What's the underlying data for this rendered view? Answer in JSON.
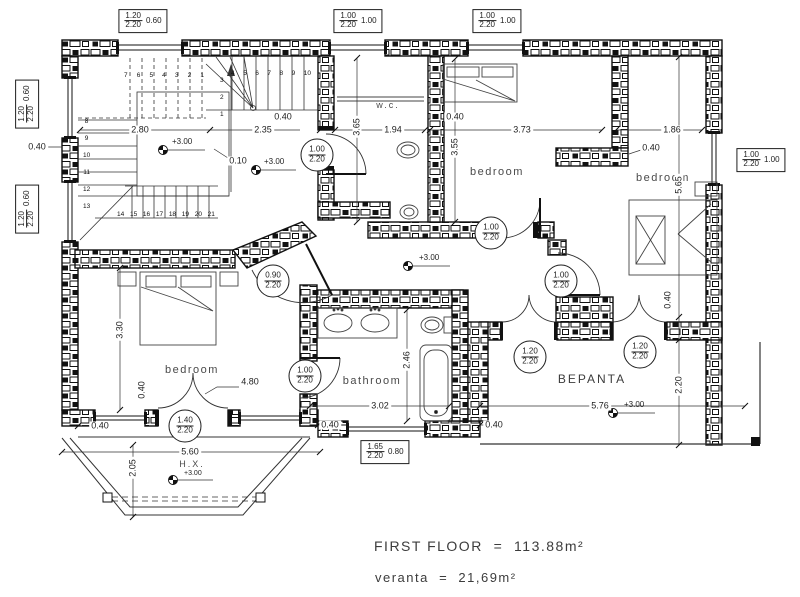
{
  "plan": {
    "rooms": [
      {
        "label": "w.c."
      },
      {
        "label": "bedroom"
      },
      {
        "label": "bedroom"
      },
      {
        "label": "bedroom"
      },
      {
        "label": "bathroom"
      },
      {
        "label": "ΒΕΡΑΝΤΑ"
      },
      {
        "label": "H.X."
      }
    ],
    "window_tags": [
      {
        "w": "1.20",
        "h": "2.20",
        "sill": "0.60"
      },
      {
        "w": "1.00",
        "h": "2.20",
        "sill": "1.00"
      },
      {
        "w": "1.00",
        "h": "2.20",
        "sill": "1.00"
      },
      {
        "w": "1.20",
        "h": "2.20",
        "sill": "0.60"
      },
      {
        "w": "1.20",
        "h": "2.20",
        "sill": "0.60"
      },
      {
        "w": "1.00",
        "h": "2.20",
        "sill": "1.00"
      },
      {
        "w": "1.65",
        "h": "2.20",
        "sill": "0.80"
      }
    ],
    "door_tags": [
      {
        "w": "1.00",
        "h": "2.20"
      },
      {
        "w": "1.00",
        "h": "2.20"
      },
      {
        "w": "1.00",
        "h": "2.20"
      },
      {
        "w": "0.90",
        "h": "2.20"
      },
      {
        "w": "1.00",
        "h": "2.20"
      },
      {
        "w": "1.20",
        "h": "2.20"
      },
      {
        "w": "1.20",
        "h": "2.20"
      },
      {
        "w": "1.40",
        "h": "2.20"
      }
    ],
    "dimensions": [
      {
        "value": "2.80"
      },
      {
        "value": "2.35"
      },
      {
        "value": "1.94"
      },
      {
        "value": "3.73"
      },
      {
        "value": "1.86"
      },
      {
        "value": "0.40"
      },
      {
        "value": "0.40"
      },
      {
        "value": "0.40"
      },
      {
        "value": "0.40"
      },
      {
        "value": "0.10"
      },
      {
        "value": "3.65"
      },
      {
        "value": "3.55"
      },
      {
        "value": "5.65"
      },
      {
        "value": "3.30"
      },
      {
        "value": "2.46"
      },
      {
        "value": "3.02"
      },
      {
        "value": "4.80"
      },
      {
        "value": "5.76"
      },
      {
        "value": "5.60"
      },
      {
        "value": "2.05"
      },
      {
        "value": "2.20"
      },
      {
        "value": "0.40"
      },
      {
        "value": "0.40"
      },
      {
        "value": "0.40"
      },
      {
        "value": "0.40"
      },
      {
        "value": "0.40"
      }
    ],
    "levels": [
      "+3.00",
      "+3.00",
      "+3.00",
      "+3.00",
      "+3.00"
    ],
    "stairs": {
      "upper_run": [
        "7",
        "6",
        "5",
        "4",
        "3",
        "2",
        "1"
      ],
      "winder": [
        "3",
        "2",
        "1"
      ],
      "top_run": [
        "4",
        "5",
        "6",
        "7",
        "8",
        "9",
        "10"
      ],
      "left_run": [
        "8",
        "9",
        "10",
        "11",
        "12",
        "13"
      ],
      "bottom_run": [
        "14",
        "15",
        "16",
        "17",
        "18",
        "19",
        "20",
        "21"
      ]
    },
    "legend": {
      "line1": "FIRST FLOOR  =  113.88m²",
      "line2": "veranta  =  21,69m²"
    }
  }
}
